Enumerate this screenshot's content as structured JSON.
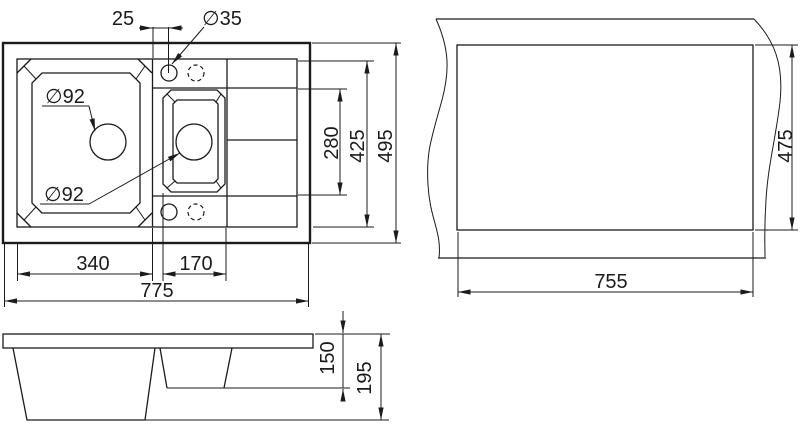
{
  "page": {
    "background": "#ffffff",
    "line_color": "#1b1b1b",
    "description": "Technical dimension drawing of a 1.5-bowl kitchen sink: top plan view, countertop cutout view, side section view"
  },
  "plan_view": {
    "dims": {
      "faucet_offset": "25",
      "faucet_hole_dia": "∅35",
      "main_drain_dia": "∅92",
      "small_drain_dia": "∅92",
      "main_bowl_width": "340",
      "small_bowl_width": "170",
      "total_width": "775",
      "bowl_opening_height": "280",
      "inner_height": "425",
      "total_height": "495"
    }
  },
  "cutout_view": {
    "dims": {
      "cutout_width": "755",
      "cutout_height": "475"
    }
  },
  "side_view": {
    "dims": {
      "small_bowl_depth": "150",
      "total_depth": "195"
    }
  }
}
